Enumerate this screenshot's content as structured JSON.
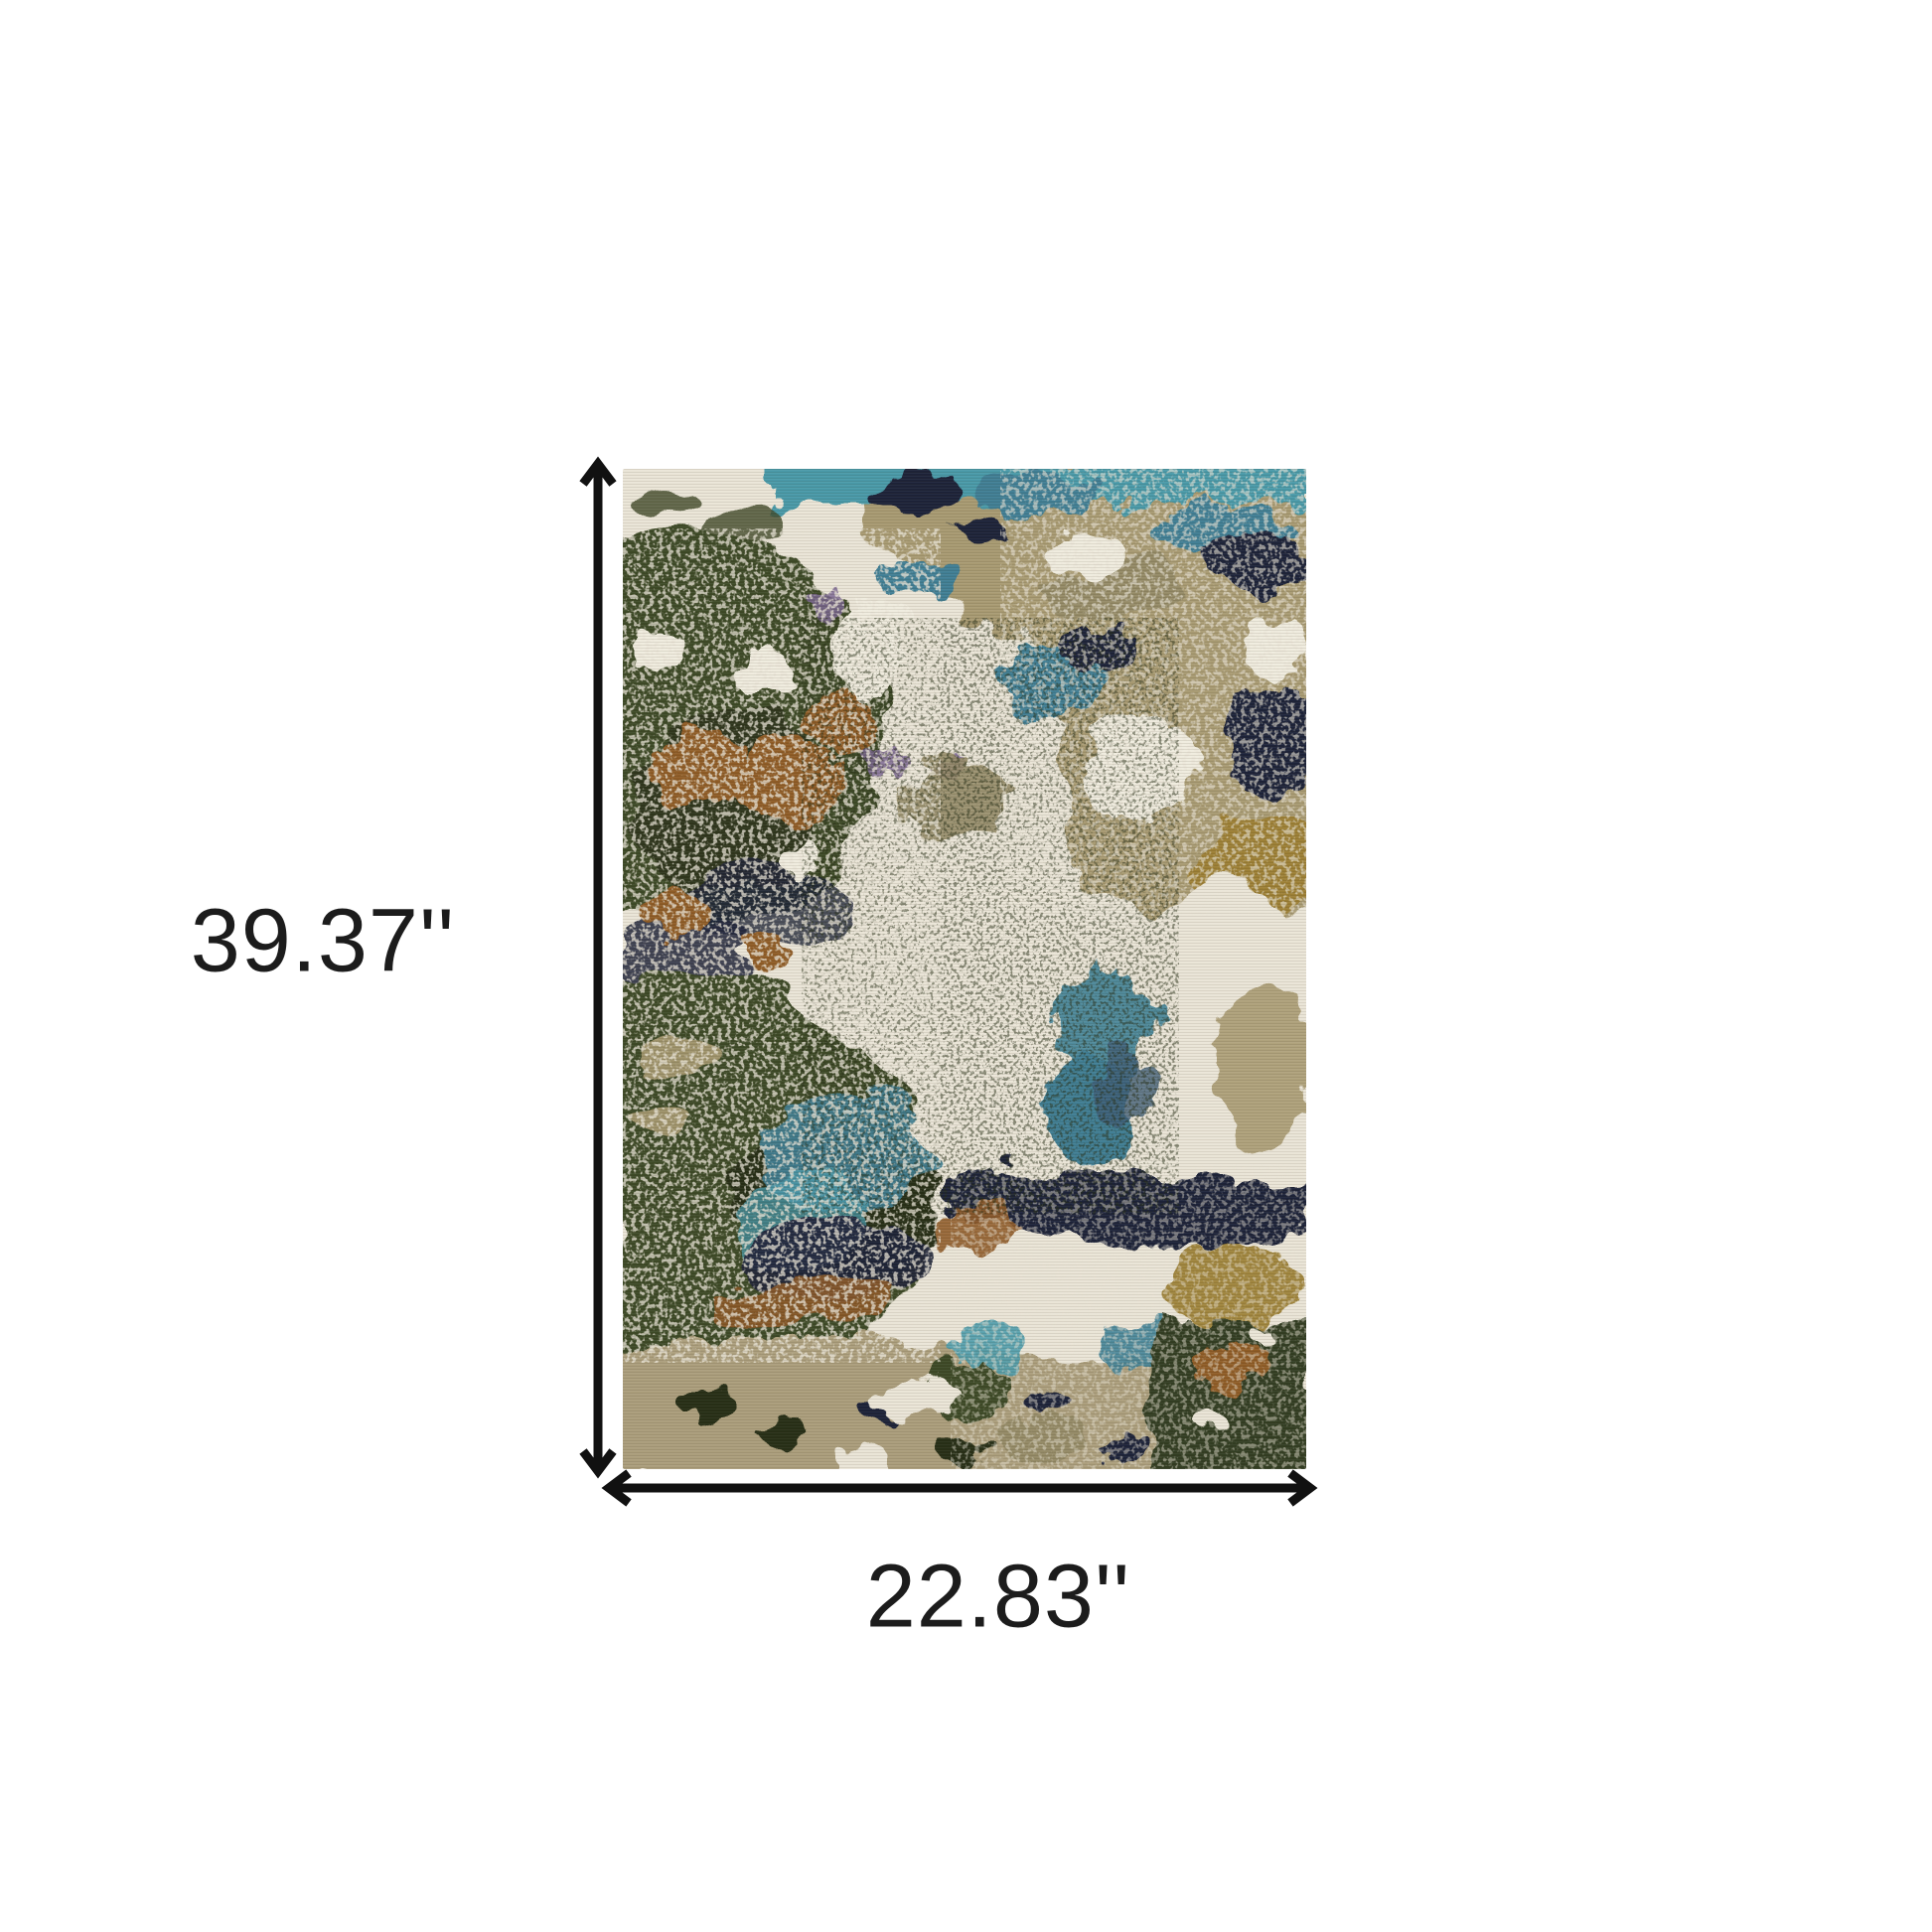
{
  "figure": {
    "type": "product-dimension-diagram",
    "height_label": "39.37''",
    "width_label": "22.83''",
    "arrow_color": "#111111",
    "text_color": "#1c1c1c",
    "background": "#ffffff"
  },
  "rug": {
    "style": "abstract distressed area rug",
    "palette": {
      "ivory": "#EAE5D7",
      "cream": "#F0ECDF",
      "tan": "#A89A72",
      "khaki": "#948A66",
      "olive": "#3E4827",
      "olive_deep": "#272E18",
      "teal": "#3F7E94",
      "teal_bright": "#4A99A8",
      "steel": "#3F5D74",
      "navy": "#1E2438",
      "rust": "#8F5B28",
      "gold": "#9C7F35",
      "mauve": "#7A6590",
      "bottom_tan": "#AB9E7B",
      "forest": "#323D22"
    }
  }
}
